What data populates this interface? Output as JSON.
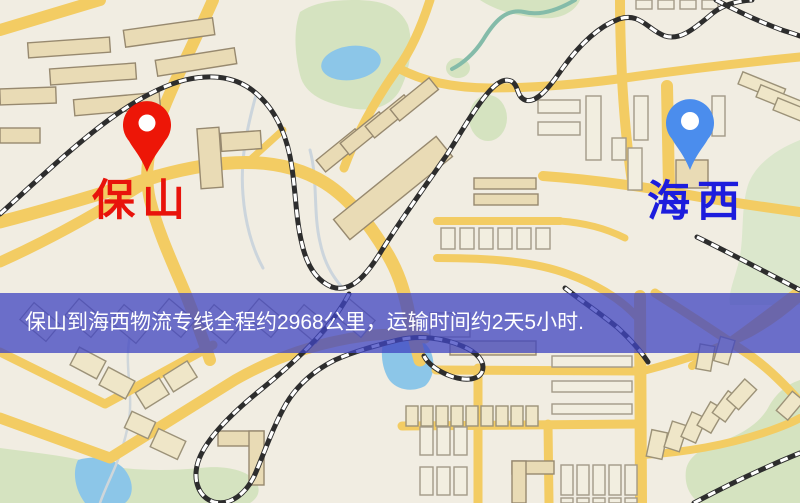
{
  "map": {
    "origin": {
      "label": "保山",
      "pin_color": "#ed1607",
      "label_color": "#e8130b"
    },
    "destination": {
      "label": "海西",
      "pin_color": "#4b8ded",
      "label_color": "#1d1ddd"
    }
  },
  "banner": {
    "text": "保山到海西物流专线全程约2968公里，运输时间约2天5小时.",
    "bg_color": "#4046c1",
    "text_color": "#ffffff"
  }
}
